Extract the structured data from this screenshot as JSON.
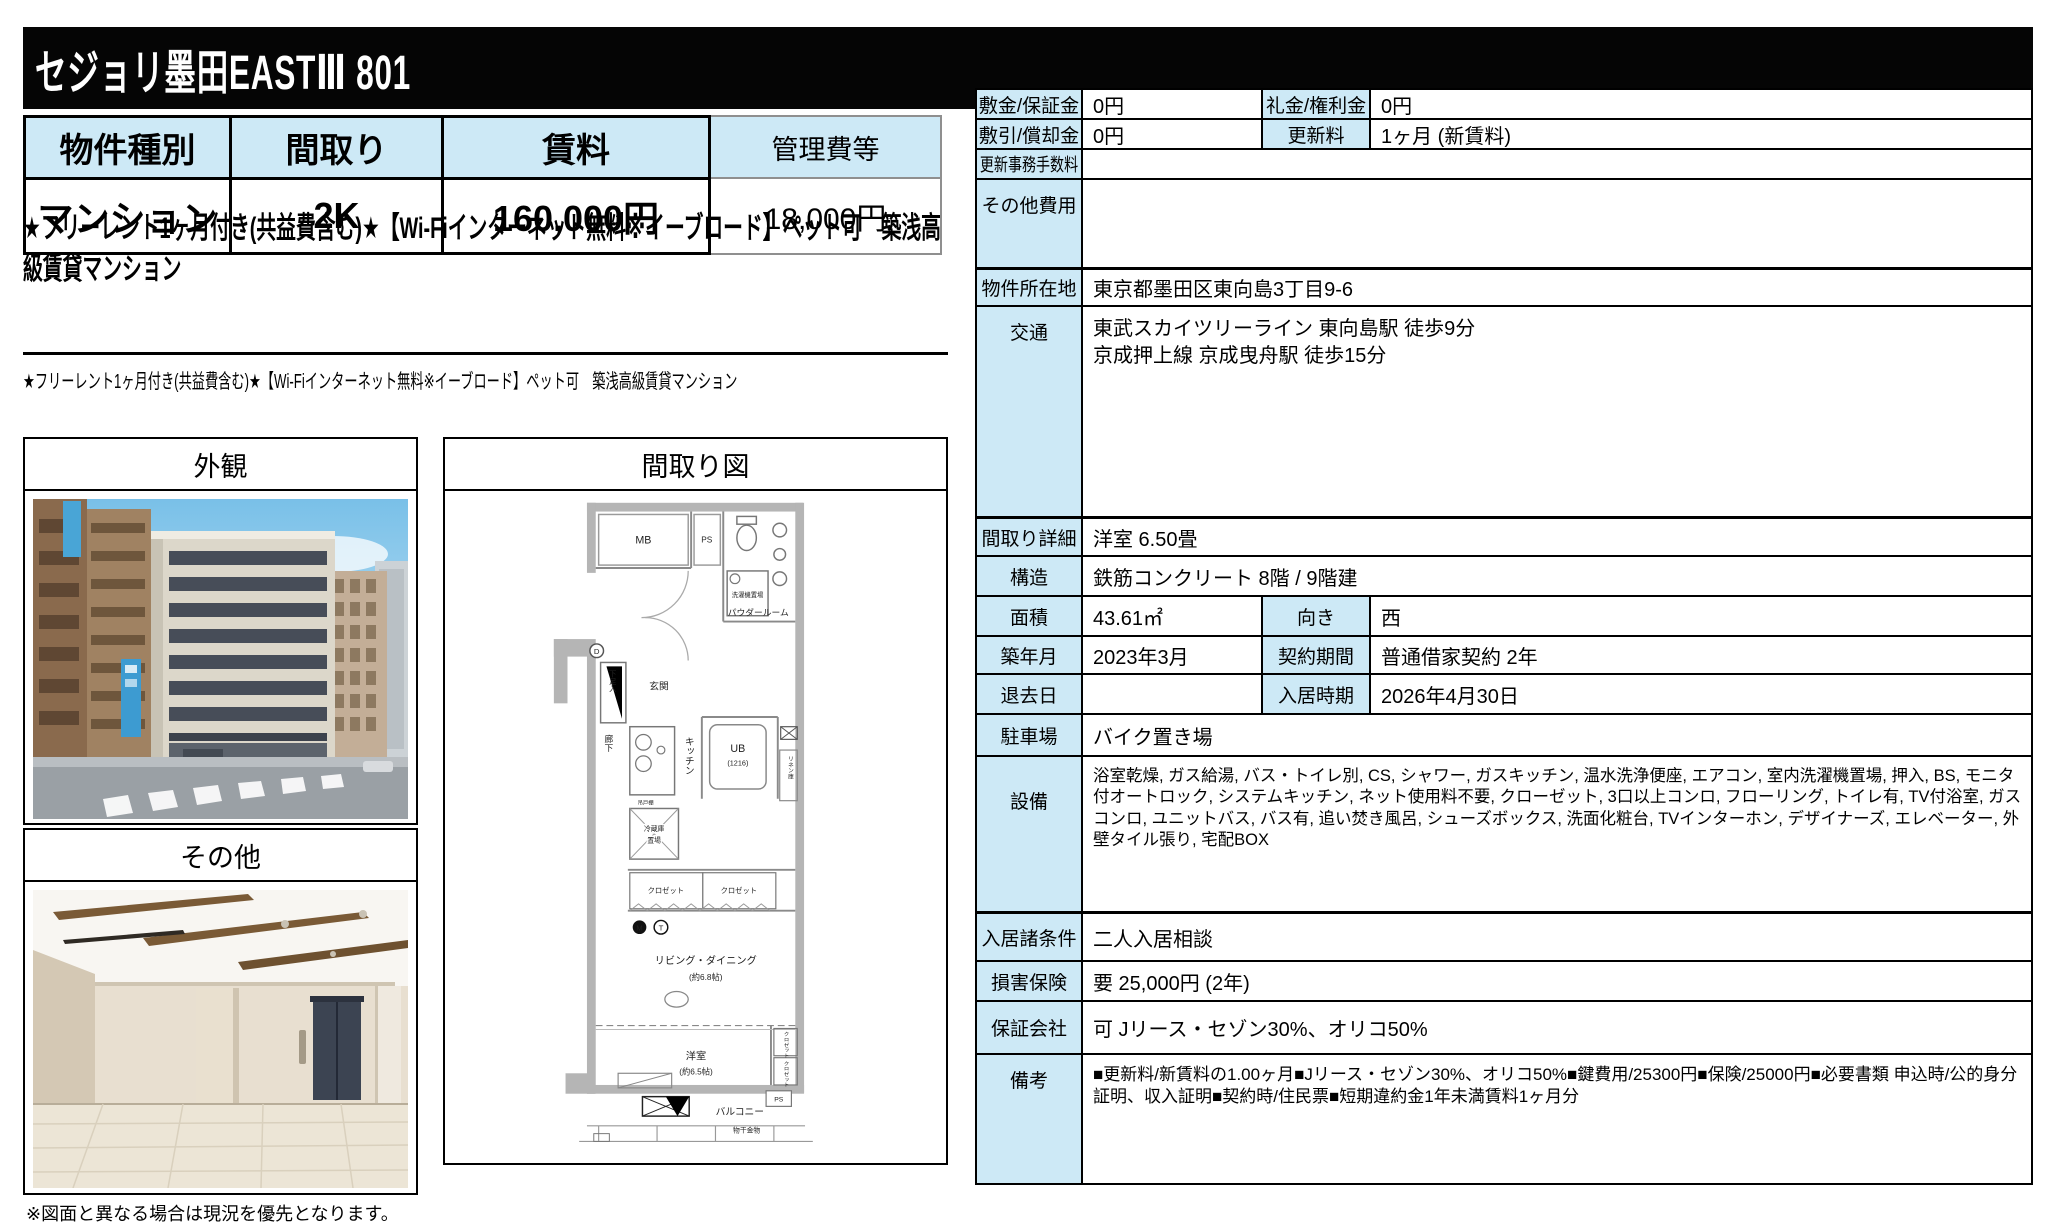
{
  "title": "セジョリ墨田EASTⅢ 801",
  "summary": {
    "headers": [
      "物件種別",
      "間取り",
      "賃料",
      "管理費等"
    ],
    "values": [
      "マンション",
      "2K",
      "160,000円",
      "18,000円"
    ]
  },
  "headline": "★フリーレント1ヶ月付き(共益費含む)★【Wi-Fiインターネット無料※イーブロード】ペット可　築浅高級賃貸マンション",
  "subheadline": "★フリーレント1ヶ月付き(共益費含む)★【Wi-Fiインターネット無料※イーブロード】ペット可　築浅高級賃貸マンション",
  "photos": {
    "photo1_label": "外観",
    "photo2_label": "その他"
  },
  "floorplan": {
    "header": "間取り図",
    "labels": {
      "mb": "MB",
      "ps_top": "PS",
      "powder": "パウダールーム",
      "washer": "洗濯機置場",
      "genkan": "玄関",
      "shoe": "下足入",
      "d_mark": "D",
      "hall": "廊下",
      "kitchen": "キッチン",
      "hanging": "吊戸棚",
      "fridge1": "冷蔵庫",
      "fridge2": "置場",
      "ub": "UB",
      "ub_size": "(1216)",
      "linen": "リネン庫",
      "closet_a": "クロゼット",
      "closet_b": "クロゼット",
      "m_mark": "M",
      "t_mark": "T",
      "living": "リビング・ダイニング",
      "living_size": "(約6.8帖)",
      "bedroom": "洋室",
      "bedroom_size": "(約6.5帖)",
      "closet_c": "クロゼット",
      "closet_d": "クロゼット",
      "balcony": "バルコニー",
      "laundry": "物干金物",
      "ps_bottom": "PS"
    }
  },
  "details": {
    "rows": [
      {
        "label1": "敷金/保証金",
        "value1": "0円",
        "label2": "礼金/権利金",
        "value2": "0円"
      },
      {
        "label1": "敷引/償却金",
        "value1": "0円",
        "label2": "更新料",
        "value2": "1ヶ月 (新賃料)"
      },
      {
        "label": "更新事務手数料",
        "value": ""
      },
      {
        "label": "その他費用",
        "value": ""
      },
      {
        "label": "物件所在地",
        "value": "東京都墨田区東向島3丁目9-6"
      },
      {
        "label": "交通",
        "value": "東武スカイツリーライン 東向島駅 徒歩9分\n京成押上線 京成曳舟駅 徒歩15分"
      },
      {
        "label": "間取り詳細",
        "value": "洋室 6.50畳"
      },
      {
        "label": "構造",
        "value": "鉄筋コンクリート 8階 / 9階建"
      },
      {
        "label1": "面積",
        "value1": "43.61㎡",
        "label2": "向き",
        "value2": "西"
      },
      {
        "label1": "築年月",
        "value1": "2023年3月",
        "label2": "契約期間",
        "value2": "普通借家契約 2年"
      },
      {
        "label1": "退去日",
        "value1": "",
        "label2": "入居時期",
        "value2": "2026年4月30日"
      },
      {
        "label": "駐車場",
        "value": "バイク置き場"
      },
      {
        "label": "設備",
        "value": "浴室乾燥, ガス給湯, バス・トイレ別, CS, シャワー, ガスキッチン, 温水洗浄便座, エアコン, 室内洗濯機置場, 押入, BS, モニタ付オートロック, システムキッチン, ネット使用料不要, クローゼット, 3口以上コンロ, フローリング, トイレ有, TV付浴室, ガスコンロ, ユニットバス, バス有, 追い焚き風呂, シューズボックス, 洗面化粧台, TVインターホン, デザイナーズ, エレベーター, 外壁タイル張り, 宅配BOX"
      },
      {
        "label": "入居諸条件",
        "value": "二人入居相談"
      },
      {
        "label": "損害保険",
        "value": "要 25,000円 (2年)"
      },
      {
        "label": "保証会社",
        "value": "可 Jリース・セゾン30%、オリコ50%"
      },
      {
        "label": "備考",
        "value": "■更新料/新賃料の1.00ヶ月■Jリース・セゾン30%、オリコ50%■鍵費用/25300円■保険/25000円■必要書類 申込時/公的身分証明、収入証明■契約時/住民票■短期違約金1年未満賃料1ヶ月分"
      }
    ]
  },
  "footer_note": "※図面と異なる場合は現況を優先となります。",
  "colors": {
    "label_blue": "#cde9f6",
    "bar_black": "#050505"
  }
}
